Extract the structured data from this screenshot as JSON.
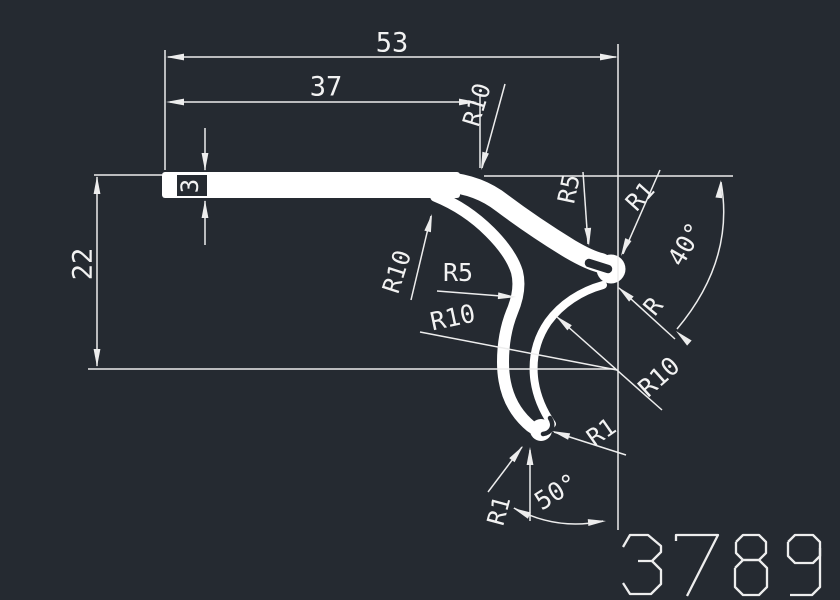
{
  "drawing": {
    "background": "#252a31",
    "line_color": "#ededed",
    "profile_color": "#ffffff",
    "part_number": "3789",
    "labels": [
      {
        "id": "dim-53",
        "text": "53",
        "x": 392,
        "y": 44,
        "rot": 0,
        "size": 27
      },
      {
        "id": "dim-37",
        "text": "37",
        "x": 326,
        "y": 88,
        "rot": 0,
        "size": 27
      },
      {
        "id": "r10-top",
        "text": "R10",
        "x": 478,
        "y": 105,
        "rot": -73,
        "size": 24
      },
      {
        "id": "dim-3",
        "text": "3",
        "x": 191,
        "y": 186,
        "rot": -90,
        "size": 24
      },
      {
        "id": "dim-22",
        "text": "22",
        "x": 84,
        "y": 264,
        "rot": -90,
        "size": 27
      },
      {
        "id": "r10-arm",
        "text": "R10",
        "x": 398,
        "y": 272,
        "rot": -72,
        "size": 24
      },
      {
        "id": "r5-mid",
        "text": "R5",
        "x": 458,
        "y": 274,
        "rot": 0,
        "size": 25
      },
      {
        "id": "r10-mid",
        "text": "R10",
        "x": 453,
        "y": 319,
        "rot": -12,
        "size": 25
      },
      {
        "id": "r5-ear",
        "text": "R5",
        "x": 570,
        "y": 189,
        "rot": -78,
        "size": 24
      },
      {
        "id": "r1-ear",
        "text": "R1",
        "x": 641,
        "y": 197,
        "rot": -48,
        "size": 24
      },
      {
        "id": "deg-40",
        "text": "40°",
        "x": 687,
        "y": 245,
        "rot": -60,
        "size": 25
      },
      {
        "id": "r-ear",
        "text": "R",
        "x": 654,
        "y": 307,
        "rot": -50,
        "size": 24
      },
      {
        "id": "r10-hook",
        "text": "R10",
        "x": 660,
        "y": 378,
        "rot": -42,
        "size": 25
      },
      {
        "id": "r1-tip",
        "text": "R1",
        "x": 602,
        "y": 433,
        "rot": -35,
        "size": 24
      },
      {
        "id": "deg-50",
        "text": "50°",
        "x": 557,
        "y": 493,
        "rot": -32,
        "size": 25
      },
      {
        "id": "r1-tip2",
        "text": "R1",
        "x": 500,
        "y": 511,
        "rot": -75,
        "size": 24
      }
    ]
  }
}
